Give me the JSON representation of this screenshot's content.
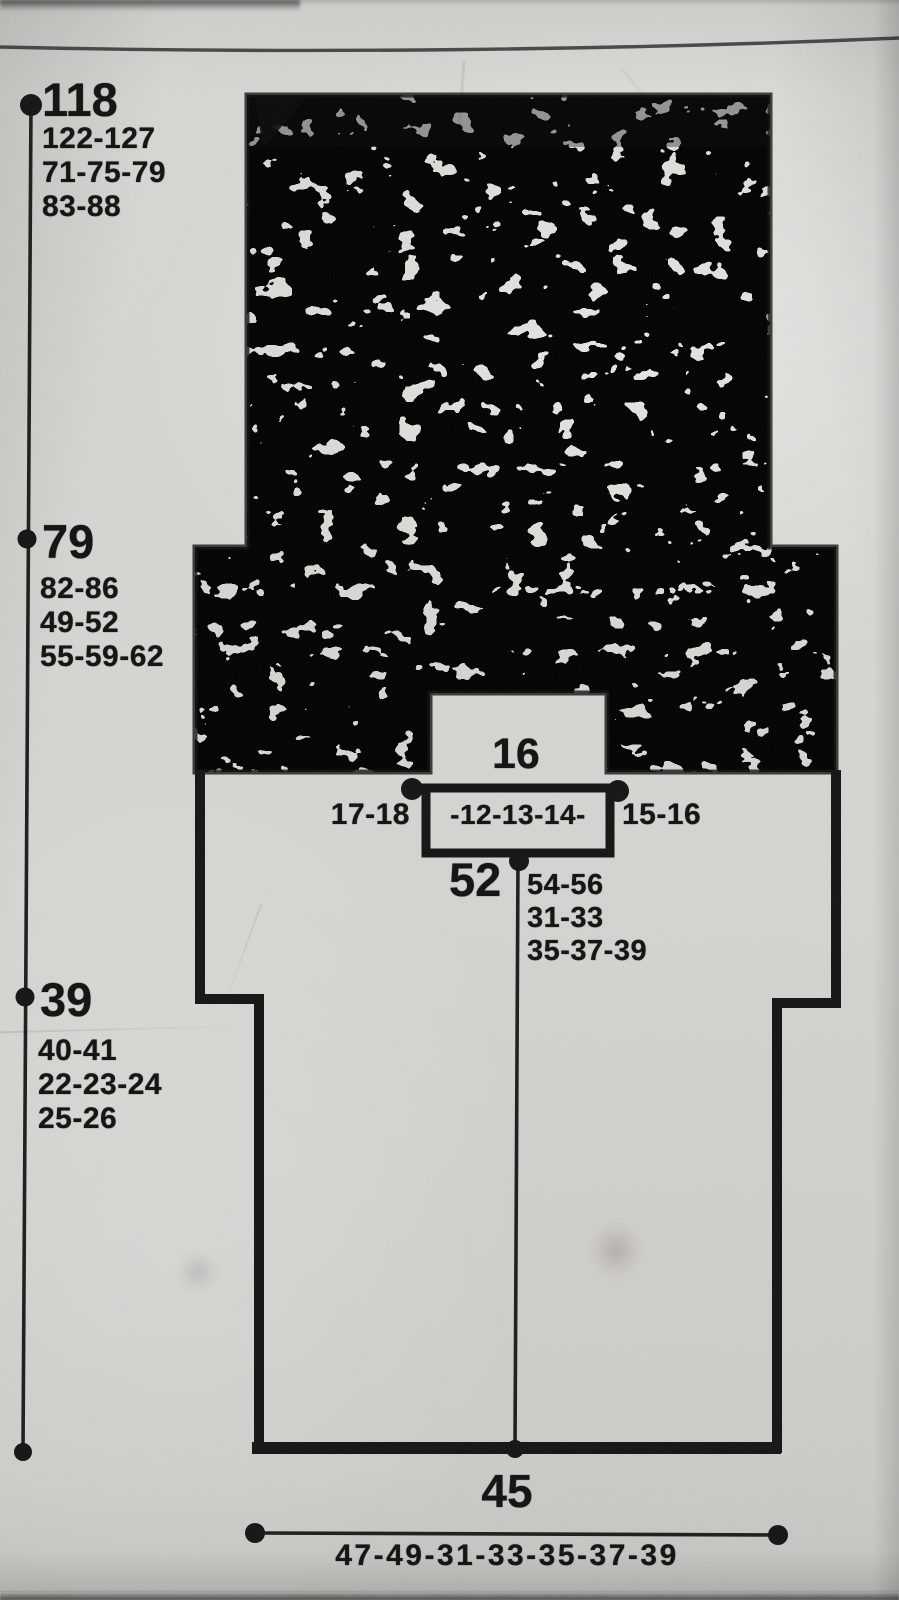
{
  "colors": {
    "ink": "#161616",
    "paper": "#d6d4d0"
  },
  "schematic": {
    "left_scale": {
      "total": {
        "value": "118",
        "alts": [
          "122-127",
          "71-75-79",
          "83-88"
        ]
      },
      "upper": {
        "value": "79",
        "alts": [
          "82-86",
          "49-52",
          "55-59-62"
        ]
      },
      "lower": {
        "value": "39",
        "alts": [
          "40-41",
          "22-23-24",
          "25-26"
        ]
      }
    },
    "neck": {
      "width": "16",
      "left_alt": "17-18",
      "inner_alt": "-12-13-14-",
      "right_alt": "15-16"
    },
    "center_length": {
      "value": "52",
      "alts": [
        "54-56",
        "31-33",
        "35-37-39"
      ]
    },
    "hem": {
      "width": "45",
      "alt": "47-49-31-33-35-37-39"
    }
  }
}
